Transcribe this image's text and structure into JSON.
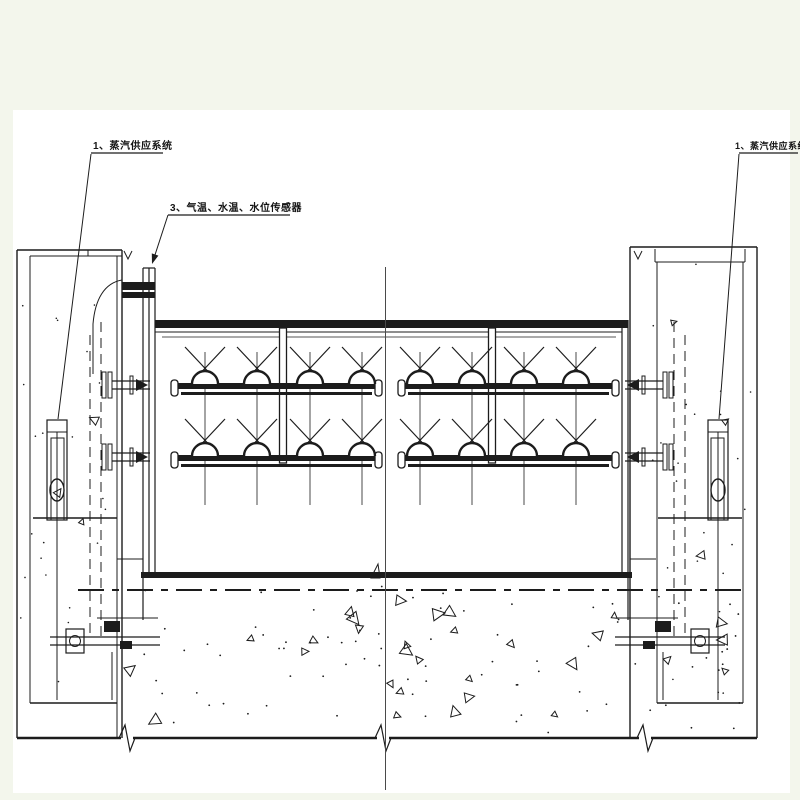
{
  "sheet": {
    "background": "#f3f6ec",
    "paper": "#ffffff",
    "ink": "#1c1c1c",
    "centerline_color": "#4a4a4a"
  },
  "annotations": {
    "left_steam_label": "1、蒸汽供应系统",
    "sensor_label": "3、气温、水温、水位传感器",
    "right_steam_label": "1、蒸汽供应系统"
  },
  "spray": {
    "beam_y": 328,
    "rows_y": [
      383,
      455
    ],
    "vertical_top": 352,
    "vertical_bottom": 505,
    "halves": [
      {
        "name": "left",
        "x0": 178,
        "x1": 375,
        "feed_x": 283,
        "nozzles": [
          205,
          257,
          310,
          362
        ]
      },
      {
        "name": "right",
        "x0": 405,
        "x1": 612,
        "feed_x": 492,
        "nozzles": [
          420,
          472,
          524,
          576
        ]
      }
    ]
  }
}
